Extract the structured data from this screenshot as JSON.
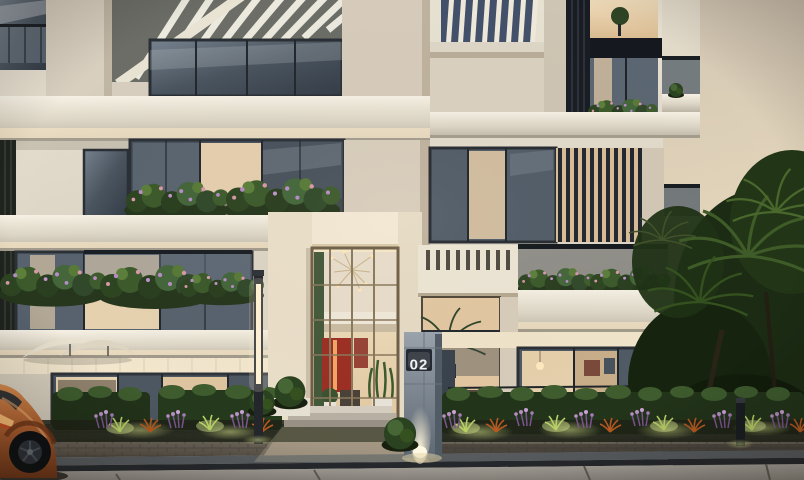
{
  "scene": {
    "title": "Residential building exterior at dusk",
    "sign": {
      "label": "02"
    },
    "colors": {
      "sky_top": "#d3c7b4",
      "sky_bottom": "#f1e3c6",
      "facade_light": "#ece5d6",
      "facade_cream": "#d6cdbc",
      "slab_white": "#f6f1e4",
      "glass_cool": "#4a545f",
      "glass_warm": "#e6cfae",
      "louver_dark": "#1a1e24",
      "foliage_dark": "#1c2c14",
      "foliage_light": "#5c7f3b",
      "flower_purple": "#b88cc8",
      "flower_orange": "#b65a20",
      "lit_grass": "#c6d87a",
      "car_copper": "#b06030",
      "totem_gray": "#7d8793",
      "sign_plate": "#232932",
      "sign_text": "#f4f6f8",
      "paver": "#80776a",
      "sidewalk": "#a29e97",
      "artwork_red": "#9d2f24"
    }
  }
}
